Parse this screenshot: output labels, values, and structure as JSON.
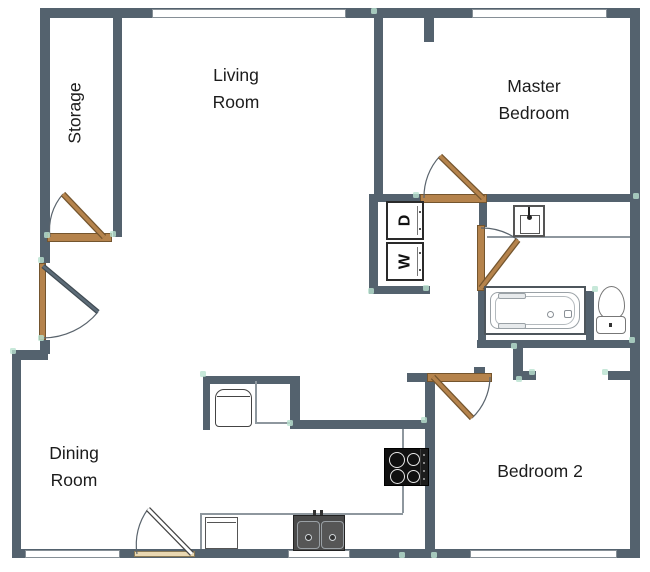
{
  "plan": {
    "rooms": {
      "storage": "Storage",
      "living_line1": "Living",
      "living_line2": "Room",
      "master_line1": "Master",
      "master_line2": "Bedroom",
      "dining_line1": "Dining",
      "dining_line2": "Room",
      "bedroom2": "Bedroom 2"
    },
    "appliances": {
      "dryer": "D",
      "washer": "W"
    },
    "colors": {
      "wall": "#54626e",
      "door-wood": "#b5834c",
      "door-wood-dark": "#74552e",
      "door-light": "#e9d8b2",
      "counter-line": "#8e979e",
      "accent-green": "#b9e2cf",
      "text": "#1c1c1c"
    }
  }
}
